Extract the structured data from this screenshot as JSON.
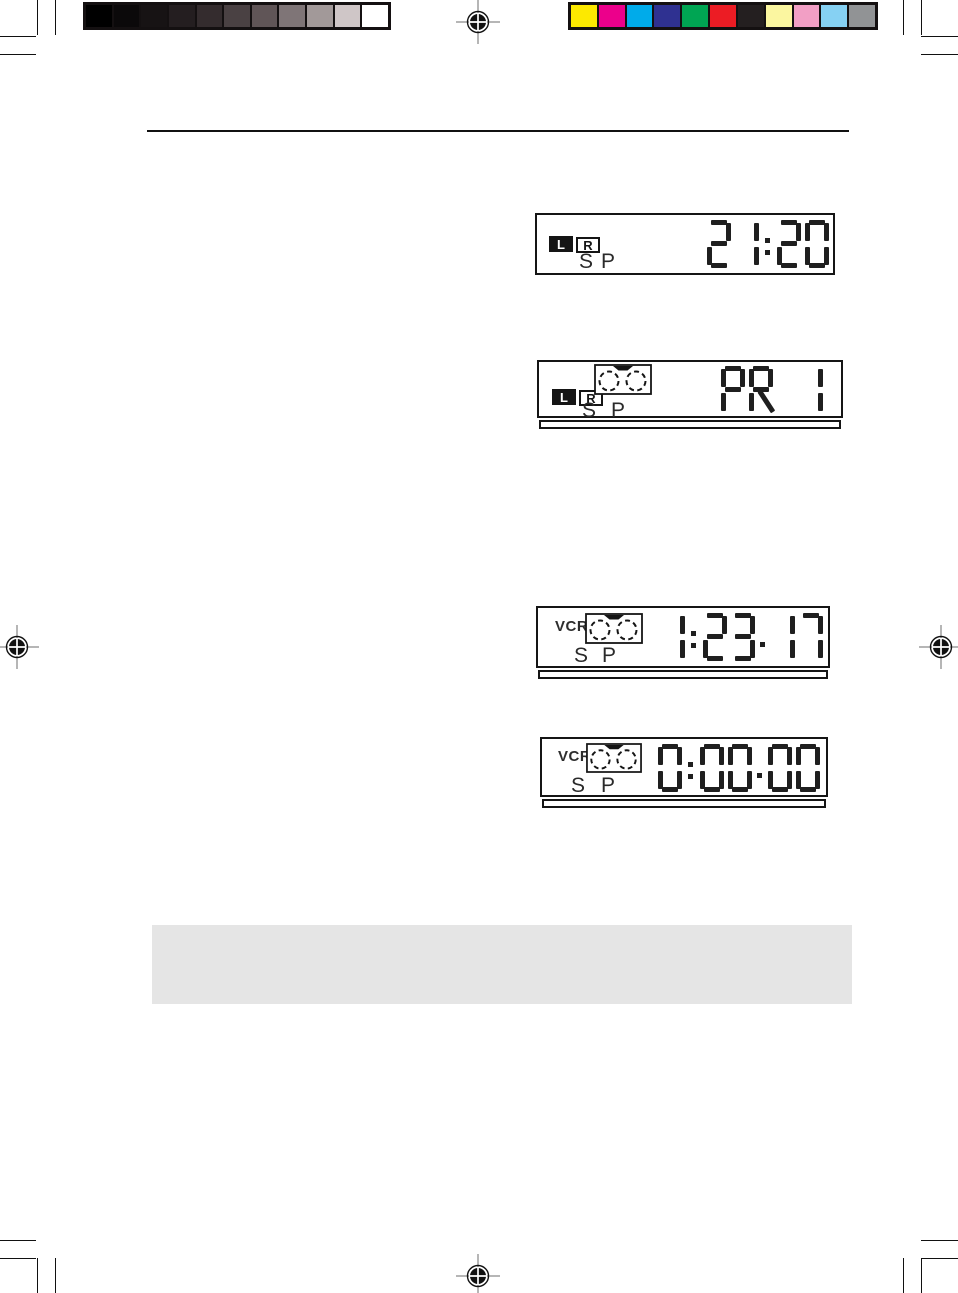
{
  "print_marks": {
    "grayscale_bar": [
      "#000000",
      "#0b090a",
      "#171314",
      "#241e20",
      "#342c2e",
      "#4a4143",
      "#605557",
      "#7f7577",
      "#a29999",
      "#cfc6c7",
      "#ffffff"
    ],
    "color_bar": [
      "#fde900",
      "#ec008b",
      "#00abea",
      "#2f3191",
      "#00a553",
      "#ec1c24",
      "#241f20",
      "#fbf6a0",
      "#f29fc5",
      "#86d1f3",
      "#919395"
    ]
  },
  "displays": [
    {
      "name": "clock-display",
      "audio_left": "L",
      "audio_right": "R",
      "speed_s": "S",
      "speed_p": "P",
      "value": "21:20"
    },
    {
      "name": "programme-display",
      "audio_left": "L",
      "audio_right": "R",
      "speed_s": "S",
      "speed_p": "P",
      "value": "PR 1"
    },
    {
      "name": "counter-display",
      "vcr_label": "VCR",
      "speed_s": "S",
      "speed_p": "P",
      "value": "1:23.17"
    },
    {
      "name": "counter-reset-display",
      "vcr_label": "VCR",
      "speed_s": "S",
      "speed_p": "P",
      "value": "0:00.00"
    }
  ]
}
